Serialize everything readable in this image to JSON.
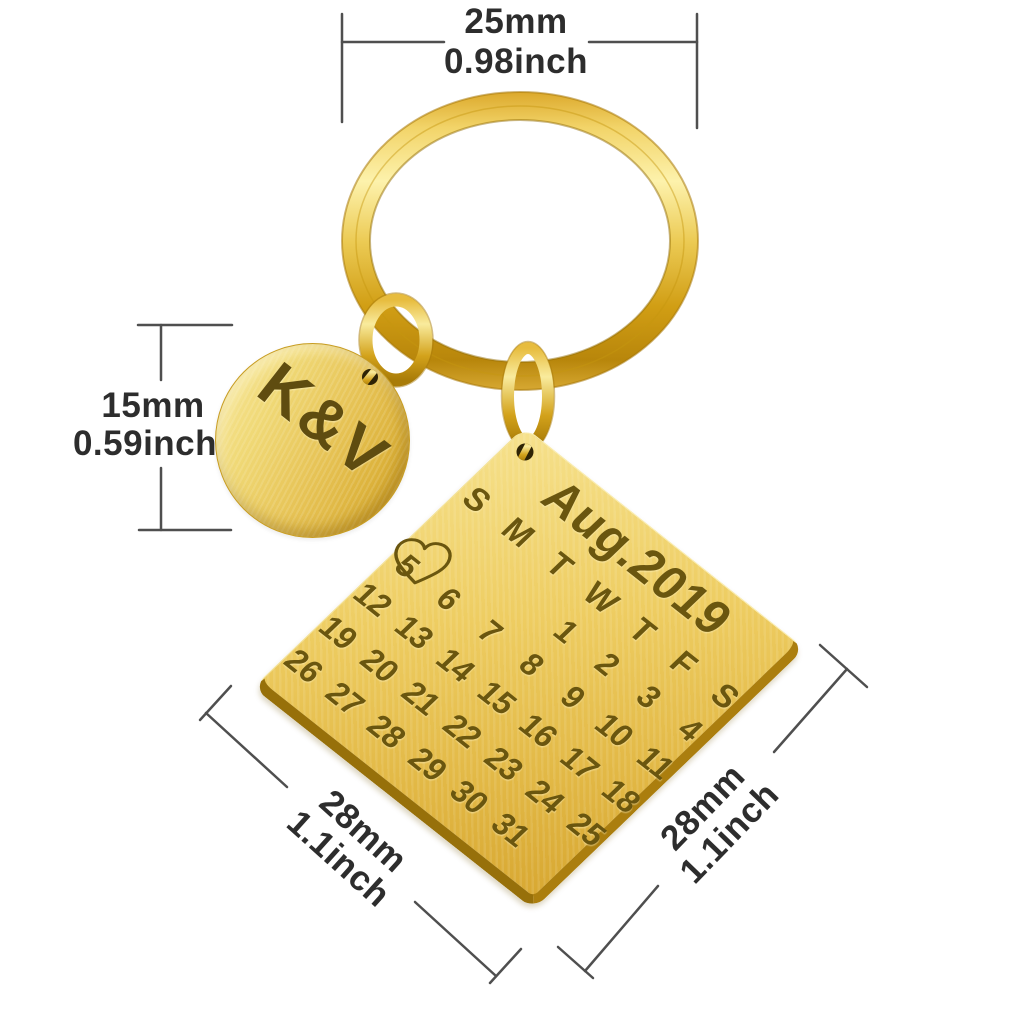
{
  "dimensions": {
    "ring_width": {
      "mm": "25mm",
      "inch": "0.98inch"
    },
    "charm_diameter": {
      "mm": "15mm",
      "inch": "0.59inch"
    },
    "plate_side_left": {
      "mm": "28mm",
      "inch": "1.1inch"
    },
    "plate_side_right": {
      "mm": "28mm",
      "inch": "1.1inch"
    }
  },
  "charm": {
    "engraving": "K&V"
  },
  "calendar": {
    "title": "Aug.2019",
    "day_headers": [
      "S",
      "M",
      "T",
      "W",
      "T",
      "F",
      "S"
    ],
    "weeks": [
      [
        "",
        "",
        "",
        "1",
        "2",
        "3",
        "4"
      ],
      [
        "5",
        "6",
        "7",
        "8",
        "9",
        "10",
        "11"
      ],
      [
        "12",
        "13",
        "14",
        "15",
        "16",
        "17",
        "18"
      ],
      [
        "19",
        "20",
        "21",
        "22",
        "23",
        "24",
        "25"
      ],
      [
        "26",
        "27",
        "28",
        "29",
        "30",
        "31",
        ""
      ]
    ],
    "highlighted_date": "5"
  },
  "icons": {
    "highlight": "heart-outline-icon"
  },
  "colors": {
    "gold_light": "#f7e189",
    "gold_mid": "#eac95a",
    "gold_deep": "#c9930f",
    "engraving": "#6a560f",
    "dimension_text": "#2d2d2d",
    "dimension_line": "#4f4f4f",
    "background": "#ffffff"
  }
}
